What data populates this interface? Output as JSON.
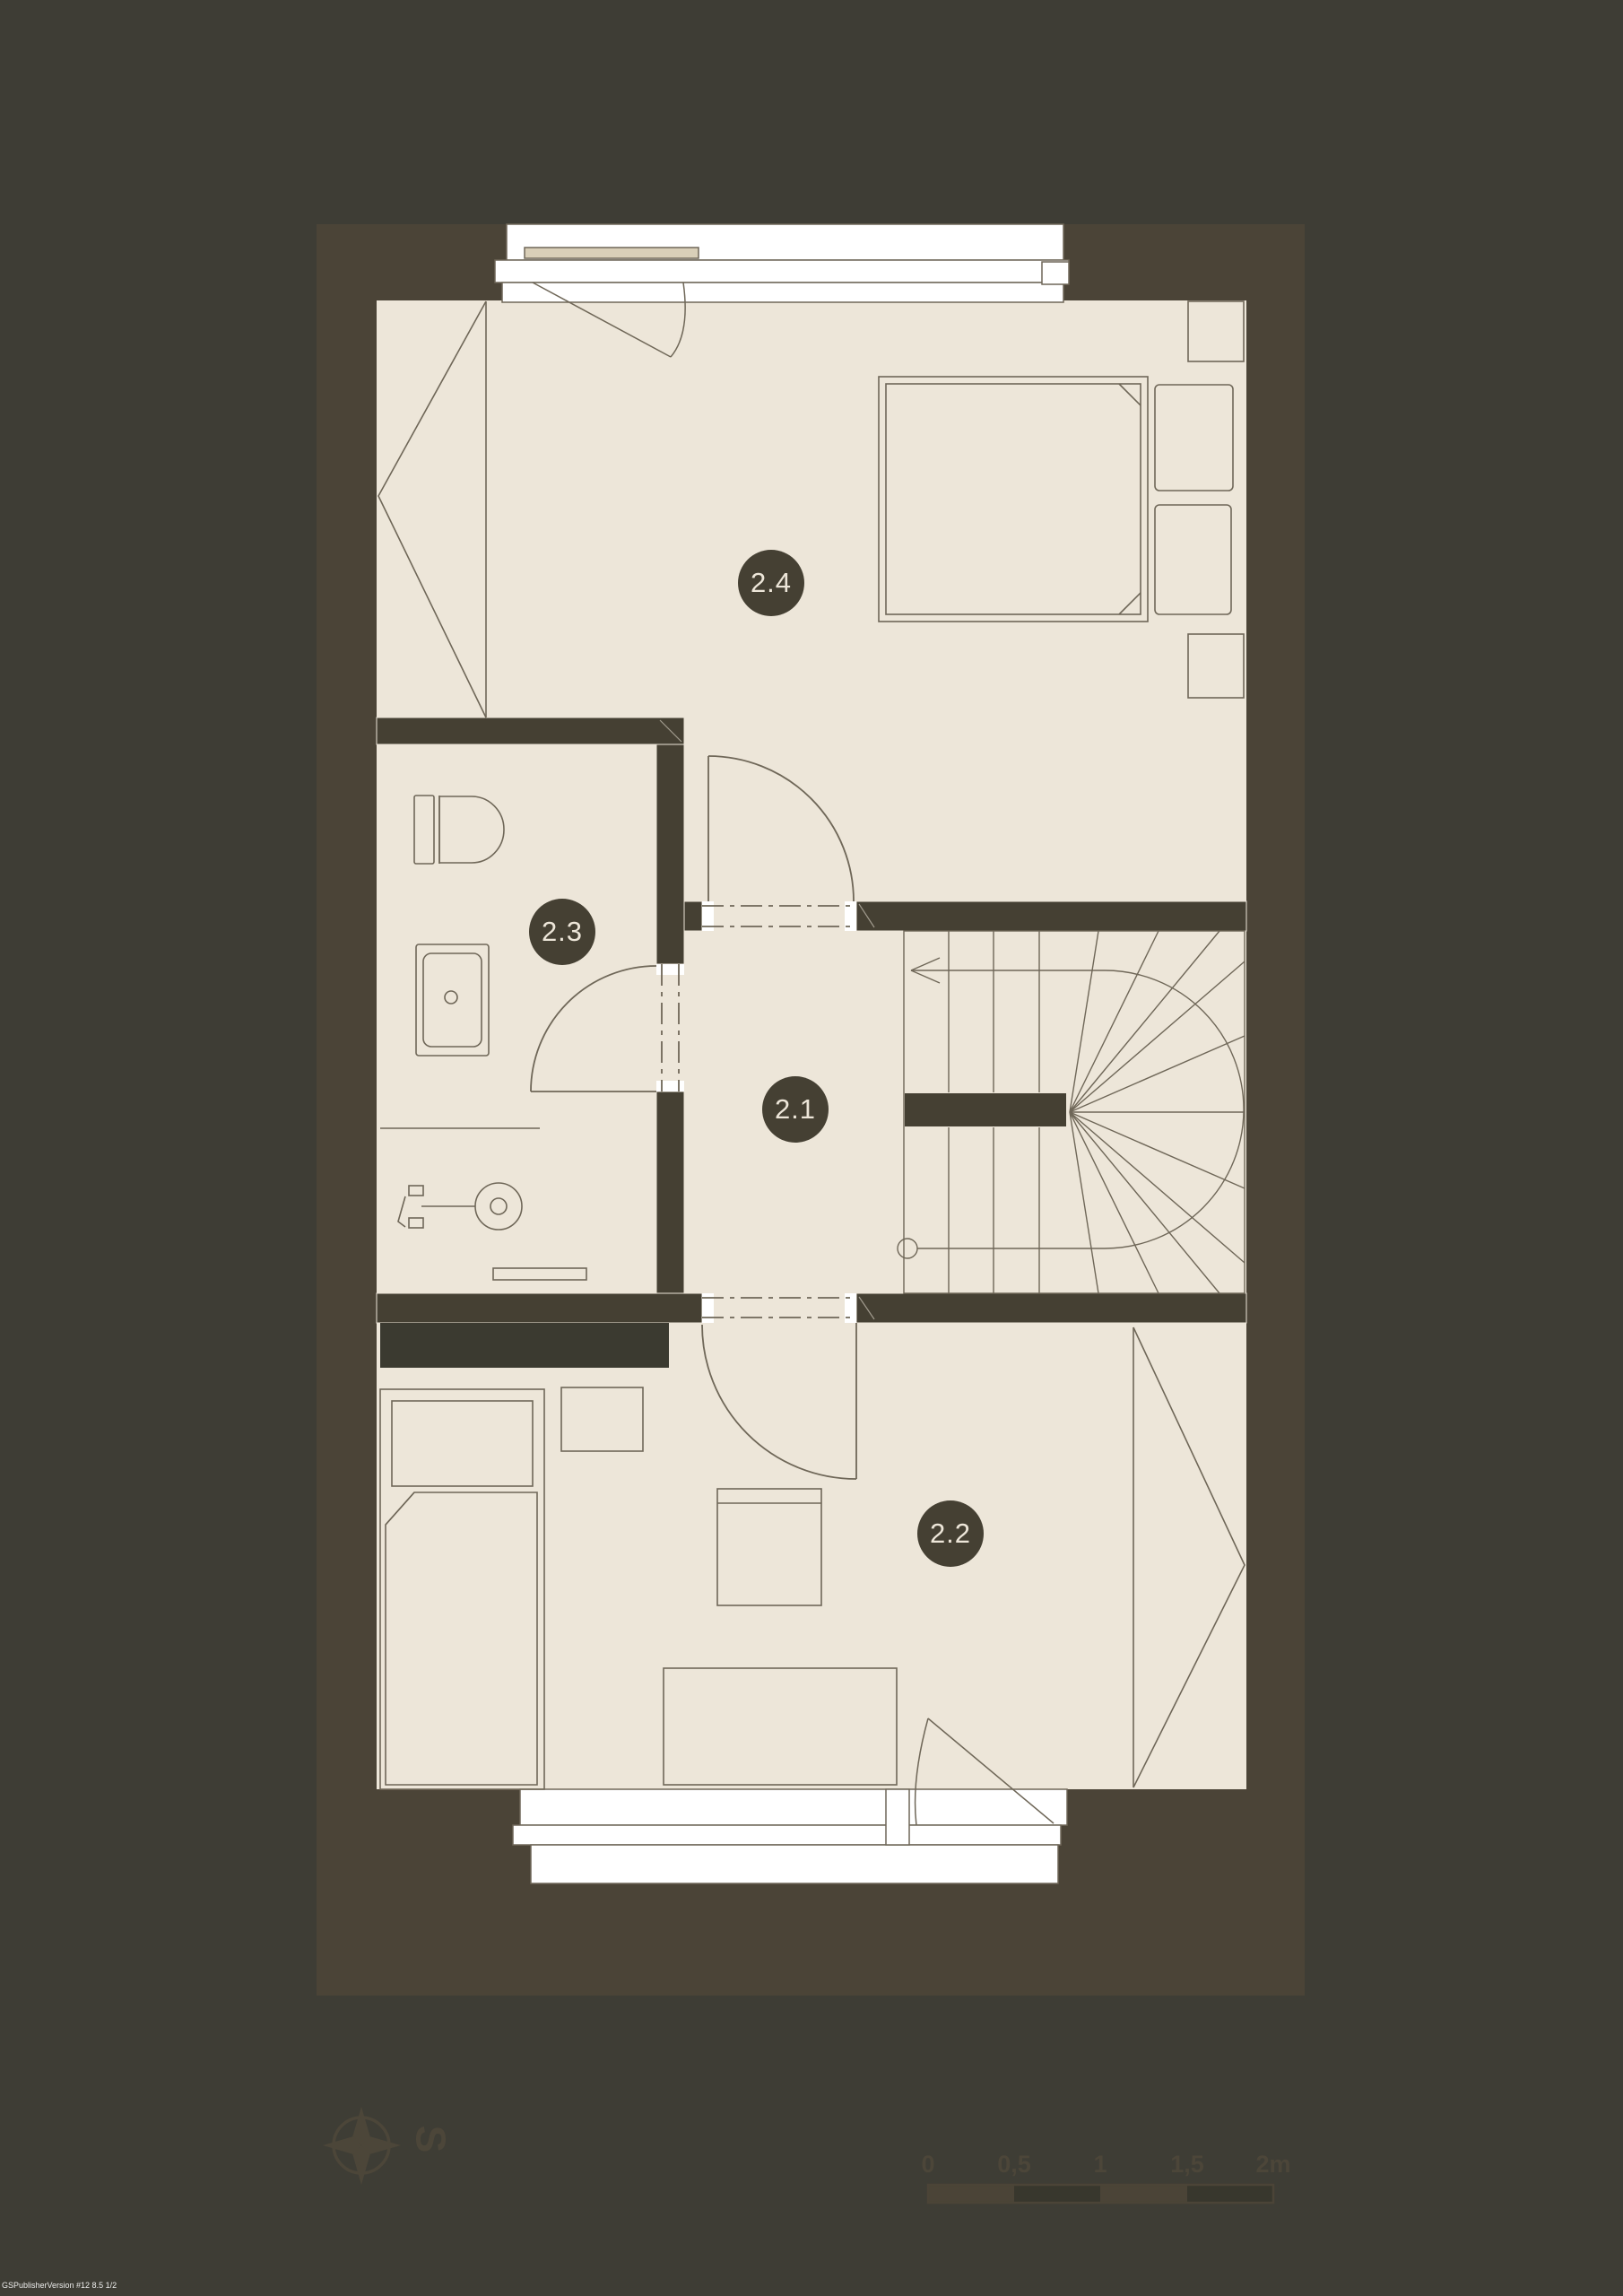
{
  "colors": {
    "bg": "#3E3D35",
    "wall_outer": "#4B4437",
    "wall_inner": "#454033",
    "floor": "#EDE6D9",
    "line": "#6F6758",
    "anno": "#4C4639",
    "window_white": "#FFFFFF",
    "sill": "#D9CFB8",
    "wardrobe": "#3B3A30",
    "scale_dark": "#38372D",
    "badge_text": "#EDE6D9"
  },
  "rooms": [
    {
      "id": "2.1",
      "label": "2.1"
    },
    {
      "id": "2.2",
      "label": "2.2"
    },
    {
      "id": "2.3",
      "label": "2.3"
    },
    {
      "id": "2.4",
      "label": "2.4"
    }
  ],
  "compass": {
    "south_label": "S"
  },
  "scale_bar": {
    "tick_labels": [
      "0",
      "0,5",
      "1",
      "1,5",
      "2m"
    ]
  },
  "watermark": {
    "text": "GSPublisherVersion #12 8.5 1/2"
  }
}
